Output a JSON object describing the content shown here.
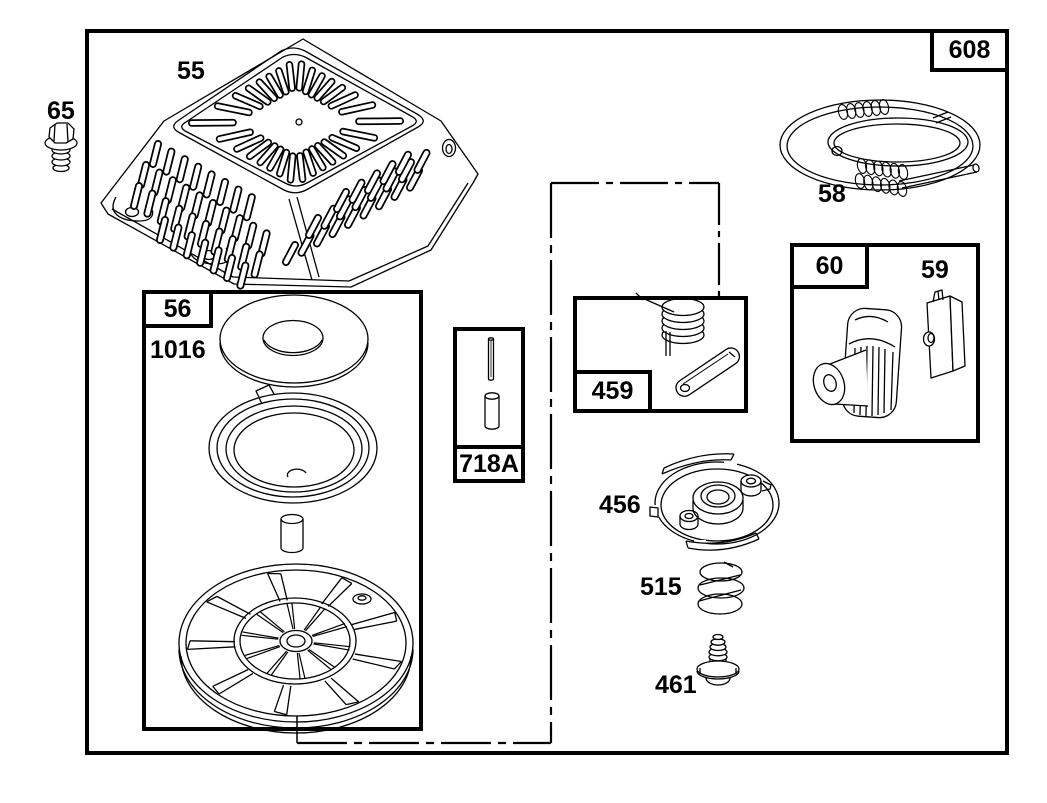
{
  "diagram": {
    "title": "Recoil starter parts exploded diagram",
    "colors": {
      "line": "#000000",
      "background": "#ffffff"
    },
    "labels": {
      "frame_ref": "608",
      "bolt": "65",
      "blower_housing": "55",
      "starter_rope_spring": "58",
      "starter_handle": "60",
      "rope_insert": "59",
      "pulley_group": "56",
      "washer": "1016",
      "pin_group": "718A",
      "pawl_group": "459",
      "retainer_plate": "456",
      "compression_spring": "515",
      "screw": "461"
    }
  }
}
